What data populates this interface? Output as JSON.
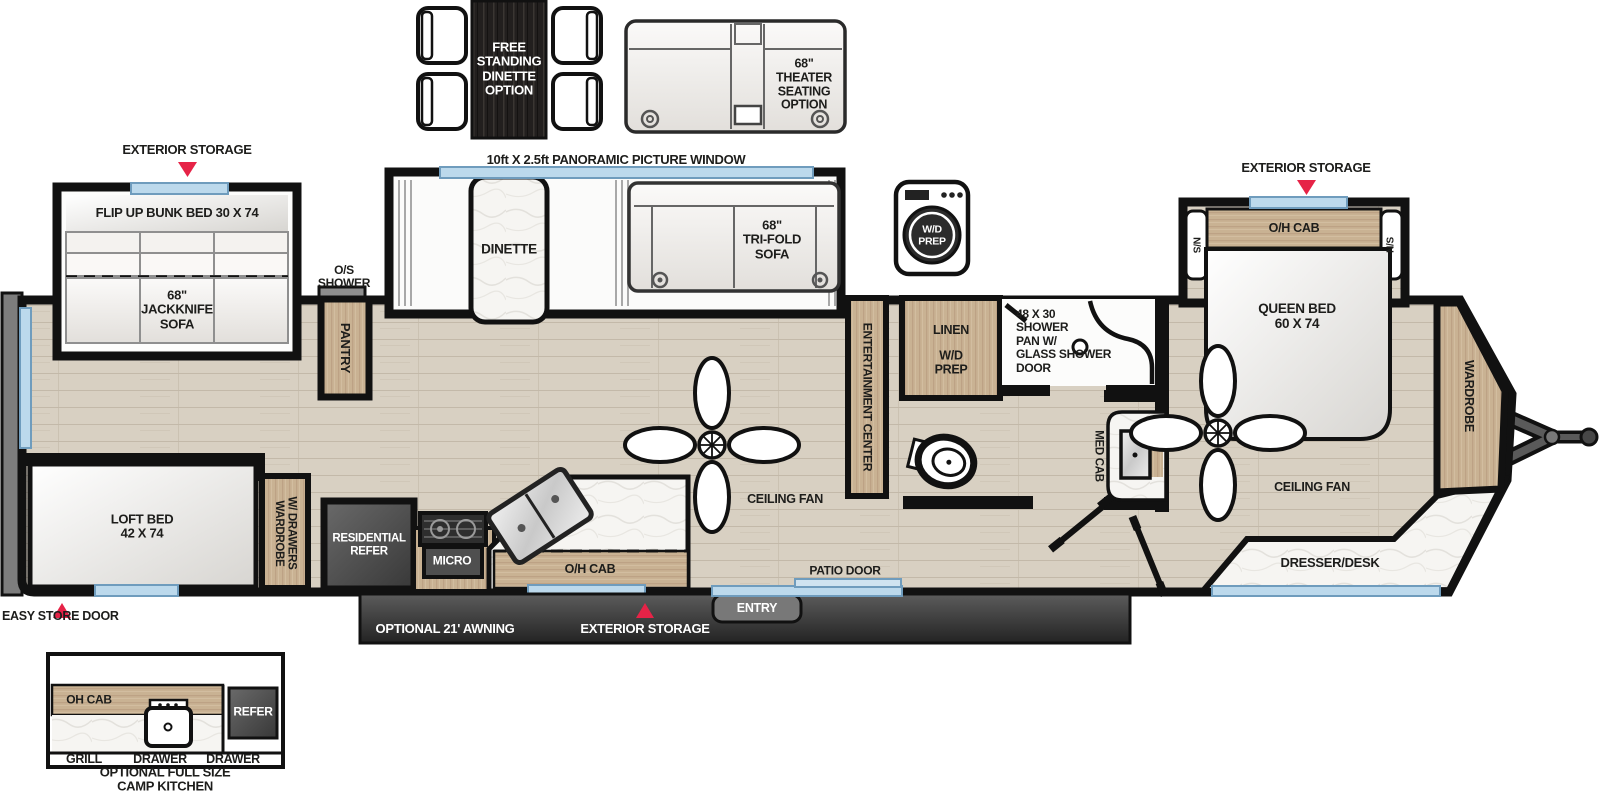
{
  "options": {
    "free_standing_dinette": "FREE\nSTANDING\nDINETTE\nOPTION",
    "theater_seating": "68\"\nTHEATER\nSEATING\nOPTION"
  },
  "callouts": {
    "panoramic_window": "10ft X 2.5ft PANORAMIC PICTURE WINDOW",
    "exterior_storage_rear": "EXTERIOR STORAGE",
    "exterior_storage_front": "EXTERIOR STORAGE",
    "exterior_storage_door_side": "EXTERIOR STORAGE",
    "easy_store_door": "EASY STORE DOOR",
    "optional_awning": "OPTIONAL 21' AWNING",
    "entry": "ENTRY",
    "patio_door": "PATIO DOOR",
    "os_shower": "O/S\nSHOWER"
  },
  "bunk_room": {
    "flip_up_bunk_bed": "FLIP UP BUNK BED 30 X 74",
    "jackknife_sofa": "68\"\nJACKKNIFE\nSOFA"
  },
  "living_kitchen": {
    "dinette": "DINETTE",
    "tri_fold_sofa": "68\"\nTRI-FOLD\nSOFA",
    "pantry": "PANTRY",
    "entertainment_center": "ENTERTAINMENT CENTER",
    "ceiling_fan": "CEILING FAN",
    "residential_refer": "RESIDENTIAL\nREFER",
    "micro": "MICRO",
    "oh_cab": "O/H CAB"
  },
  "bath_utility": {
    "washer_dryer_prep": "W/D\nPREP",
    "linen": "LINEN",
    "linen_wd_prep": "W/D\nPREP",
    "shower_pan": "48 X 30\nSHOWER\nPAN W/\nGLASS SHOWER\nDOOR",
    "med_cab": "MED CAB"
  },
  "front_bedroom": {
    "oh_cab": "O/H CAB",
    "night_stand_left": "N/S",
    "night_stand_right": "N/S",
    "queen_bed": "QUEEN BED\n60 X 74",
    "wardrobe": "WARDROBE",
    "ceiling_fan": "CEILING FAN",
    "dresser_desk": "DRESSER/DESK"
  },
  "rear_room": {
    "loft_bed": "LOFT BED\n42 X 74",
    "wardrobe_w_drawers": "WARDROBE\nW/ DRAWERS"
  },
  "camp_kitchen": {
    "oh_cab": "OH CAB",
    "refer": "REFER",
    "grill": "GRILL",
    "drawer_left": "DRAWER",
    "drawer_right": "DRAWER",
    "caption": "OPTIONAL FULL SIZE\nCAMP KITCHEN"
  },
  "colors": {
    "marker_red": "#e62347",
    "window_blue": "#bcd9ec",
    "wall_black": "#111111",
    "cabinet_wood": "#c9b293",
    "floor_wood": "#d8d0c2",
    "appliance_gray": "#4c4c4c"
  }
}
